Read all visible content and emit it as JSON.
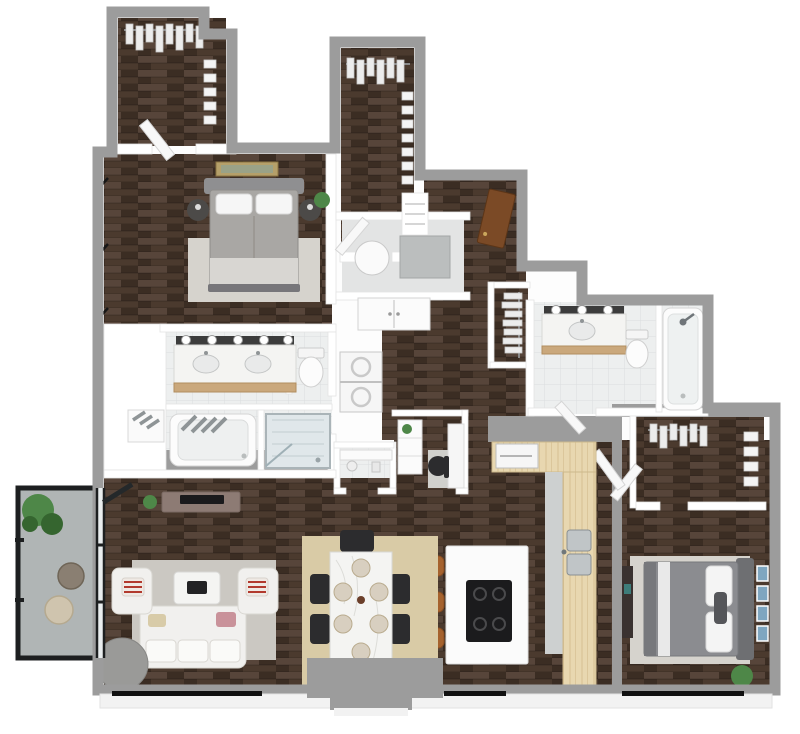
{
  "meta": {
    "kind": "3d-floor-plan-render",
    "description": "3D floor plan of a two-bedroom, two-bathroom apartment with balcony"
  },
  "colors": {
    "bg": "#ffffff",
    "wall-outer": "#9c9c9c",
    "wall-inner": "#ffffff",
    "wall-face": "#f2f2f2",
    "wood-base": "#4b3a2e",
    "wood-mid": "#57453a",
    "wood-dark": "#3b2d23",
    "tile": "#edefef",
    "tile-line": "#dadedf",
    "butcher": "#e8d7b0",
    "butcher-line": "#d6bf92",
    "concrete": "#b0b5b5",
    "railing": "#1d1f20",
    "glass": "#c5ced0",
    "rug-living": "#cbc8c2",
    "rug-dining": "#d9cba6",
    "rug-bed": "#d6d3cd",
    "sofa": "#f1f0ee",
    "sofa-line": "#d9d7d2",
    "chair-black": "#2c2c2e",
    "stool": "#a5622e",
    "marble": "#f4f4f2",
    "marble-line": "#d8d8d6",
    "cooktop": "#1b1b1d",
    "island": "#fbfbfb",
    "bed1-duvet": "#a9a7a4",
    "bed1-blanket": "#d8d6d2",
    "bed2-duvet": "#8b8c90",
    "headboard": "#8f8f91",
    "nightstand": "#4c4a48",
    "plant": "#4e8748",
    "plant-dark": "#35652f",
    "door-entry": "#7b4a26",
    "vanity-wood": "#caa87c",
    "light-strip": "#3c3c3c",
    "bulb": "#ffffff",
    "fixture-white": "#fcfcfc",
    "fixture-line": "#cfcfcf",
    "steel": "#c0c5c7",
    "tv-console": "#8d7b74",
    "tv": "#1a1a1c",
    "ottoman": "#9a9a98",
    "art-frame": "#b5a06a",
    "art-blue": "#7fa6c0",
    "towel": "#8e9496",
    "shower-tile": "#e0e7ea",
    "appliance": "#f6f6f6"
  },
  "scene": {
    "rooms": {
      "closet1": "walk-in-closet-1",
      "bedroom1": "bedroom-1",
      "closet2": "walk-in-closet-2",
      "entry": "entry-hall",
      "laundry": "laundry-room",
      "masterbath": "master-bathroom",
      "powder": "powder-room",
      "desknook": "desk-nook",
      "coatcloset": "coat-closet",
      "bath2": "bathroom-2",
      "closet3": "bedroom-2-closet",
      "bedroom2": "bedroom-2",
      "kitchen": "kitchen",
      "dining": "dining-area",
      "living": "living-room",
      "balcony": "balcony"
    },
    "furniture": [
      "queen-bed-1",
      "queen-bed-2",
      "sofa",
      "armchair-left",
      "armchair-right",
      "coffee-table",
      "round-ottoman",
      "tv-console",
      "dining-table",
      "dining-chairs",
      "kitchen-island",
      "bar-stools",
      "cooktop",
      "double-vanity",
      "single-vanity",
      "bathtub-master",
      "shower-master",
      "bathtub-2",
      "toilet-master",
      "toilet-2",
      "washer-dryer",
      "laundry-basket",
      "entry-door",
      "balcony-stools",
      "potted-plants",
      "wall-art",
      "desk-chair"
    ]
  }
}
